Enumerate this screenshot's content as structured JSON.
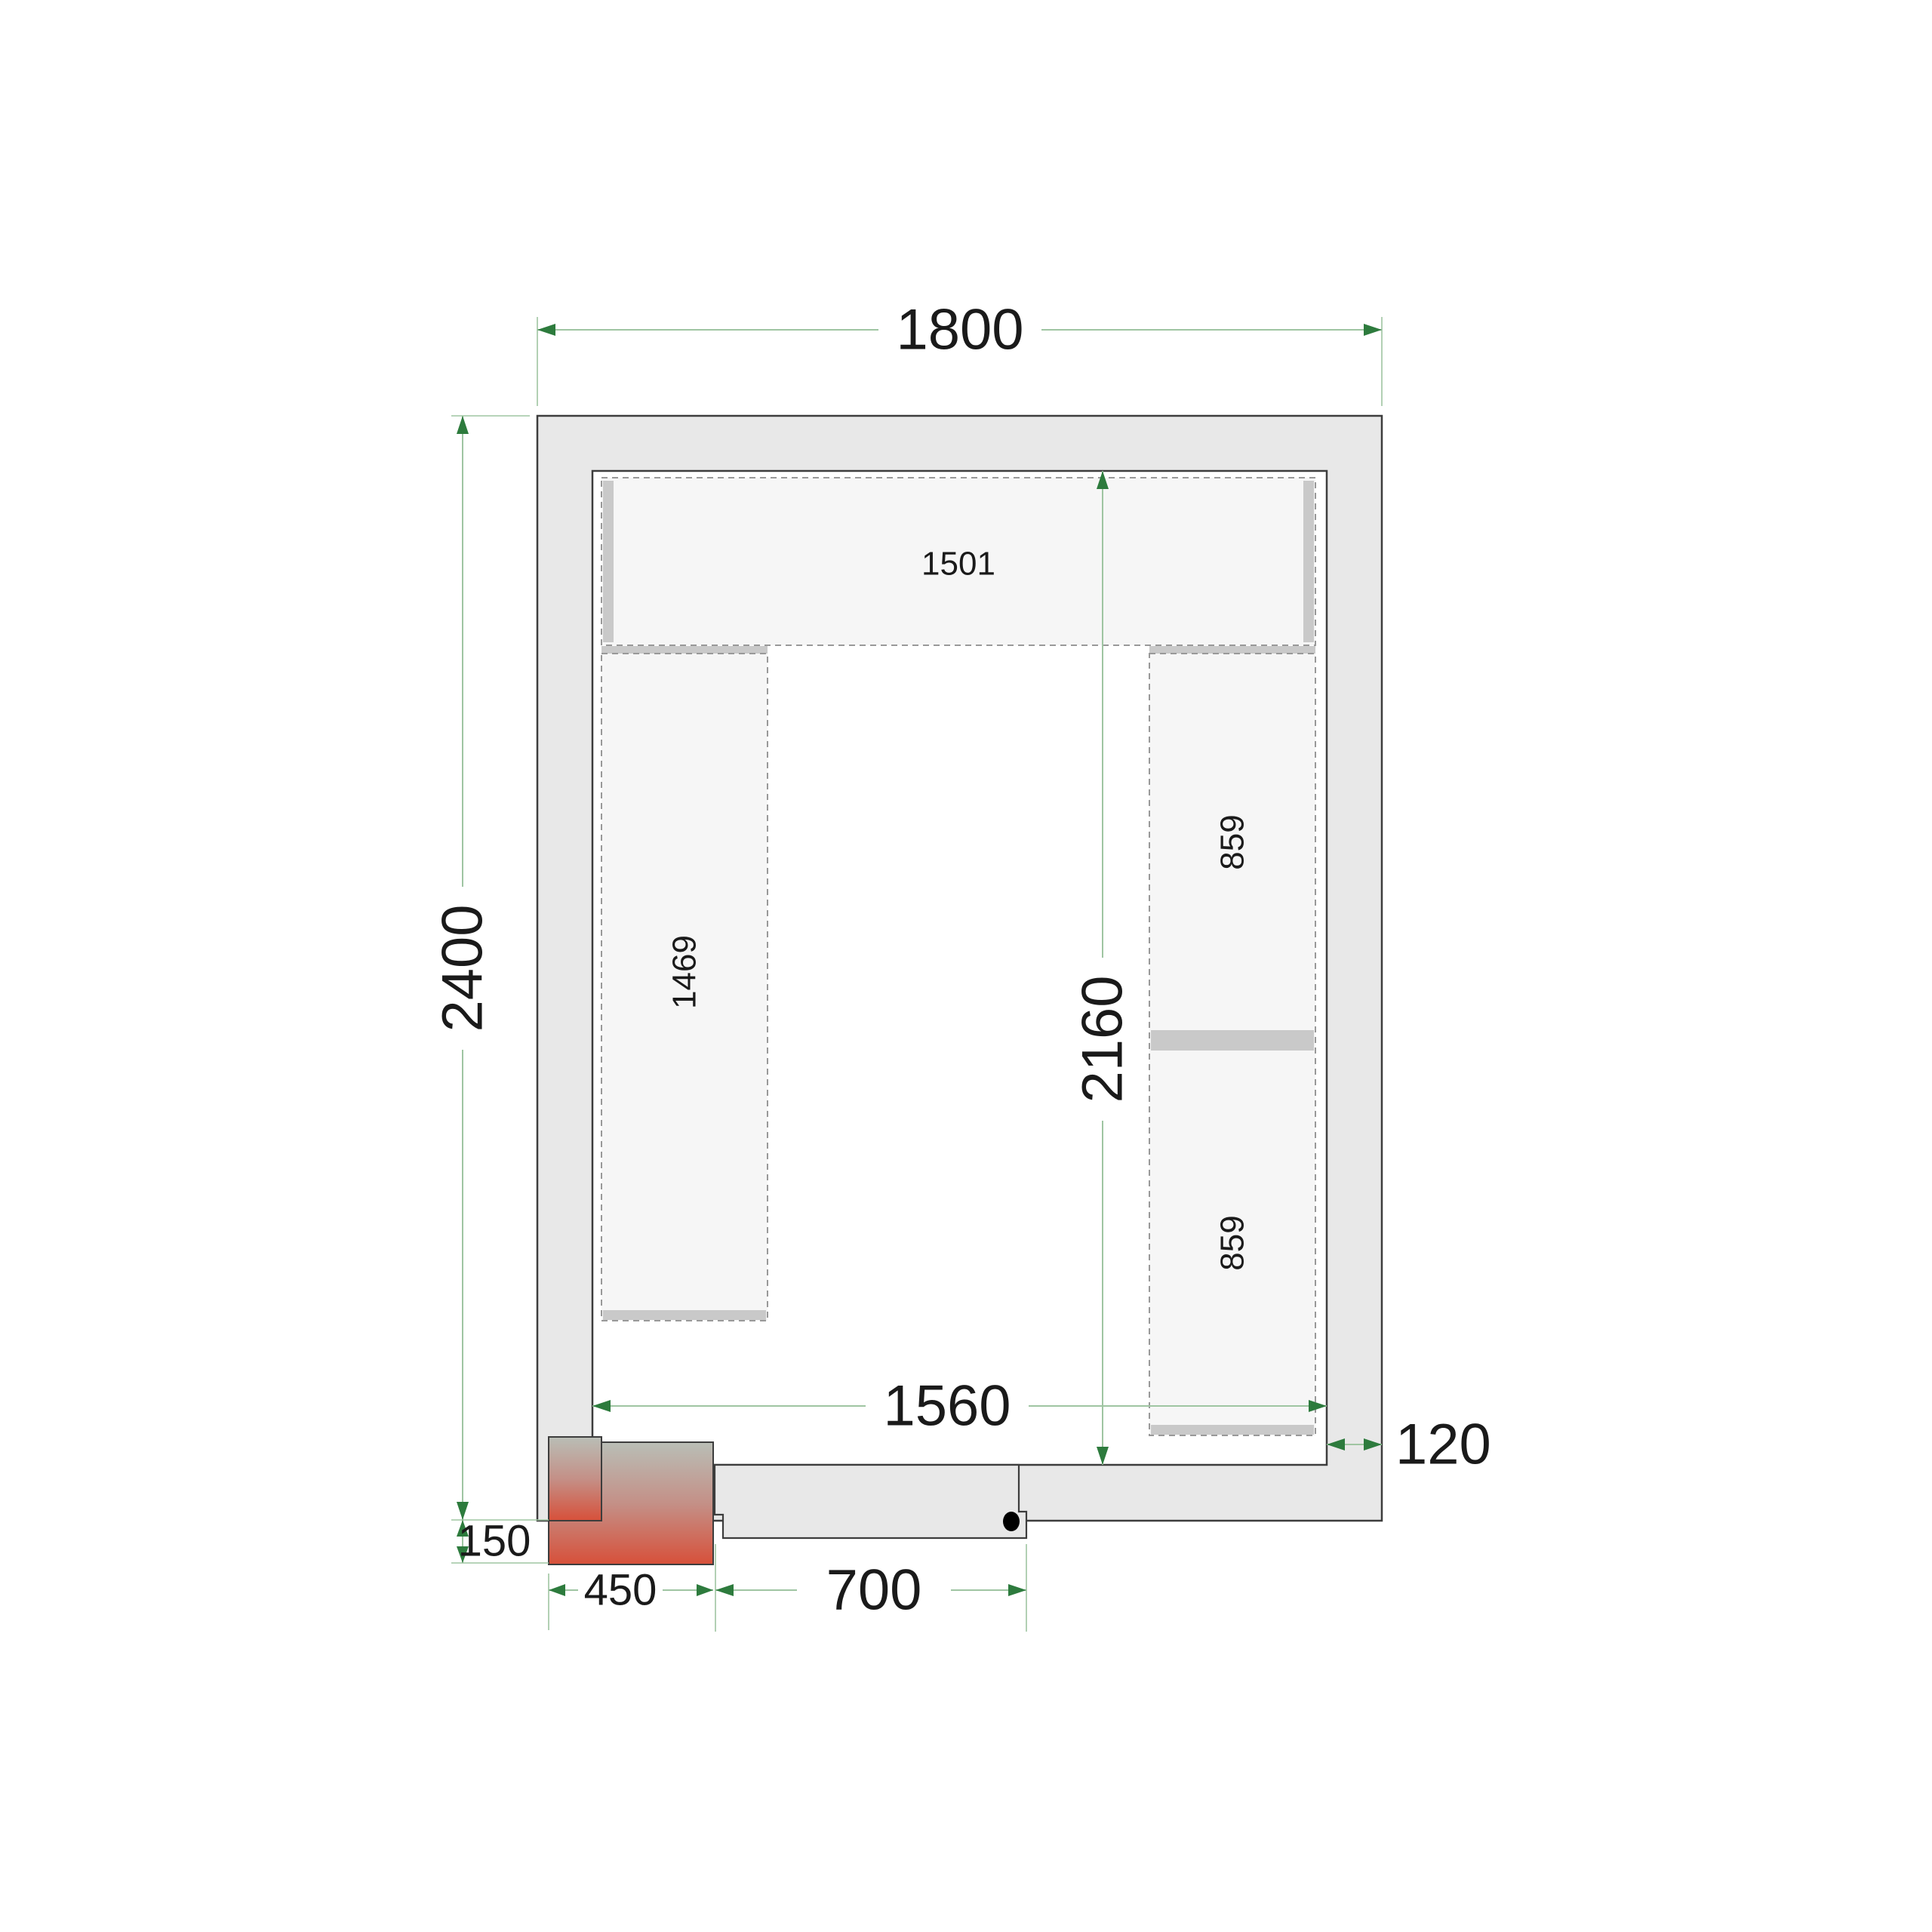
{
  "drawing": {
    "title": "Cold room floor plan",
    "dimensions": {
      "width_total": "1800",
      "depth_total": "2400",
      "width_inner": "1560",
      "depth_inner": "2160",
      "wall_thickness": "120",
      "unit_offset_depth": "150",
      "unit_width": "450",
      "door_opening": "700"
    },
    "shelves": {
      "top_length": "1501",
      "left_length": "1469",
      "right_upper_length": "859",
      "right_lower_length": "859"
    },
    "colors": {
      "wall_fill": "#e8e8e8",
      "outline": "#3d3d3d",
      "shelf_fill": "#f6f6f6",
      "shelf_dash": "#999999",
      "bracket": "#c9c9c9",
      "dim_line": "#9fc5a2",
      "dim_arrow": "#2d7b3d",
      "unit_top": "#b9beb6",
      "unit_mid": "#c49087",
      "unit_bottom": "#d7503a",
      "dot": "#000000"
    }
  }
}
